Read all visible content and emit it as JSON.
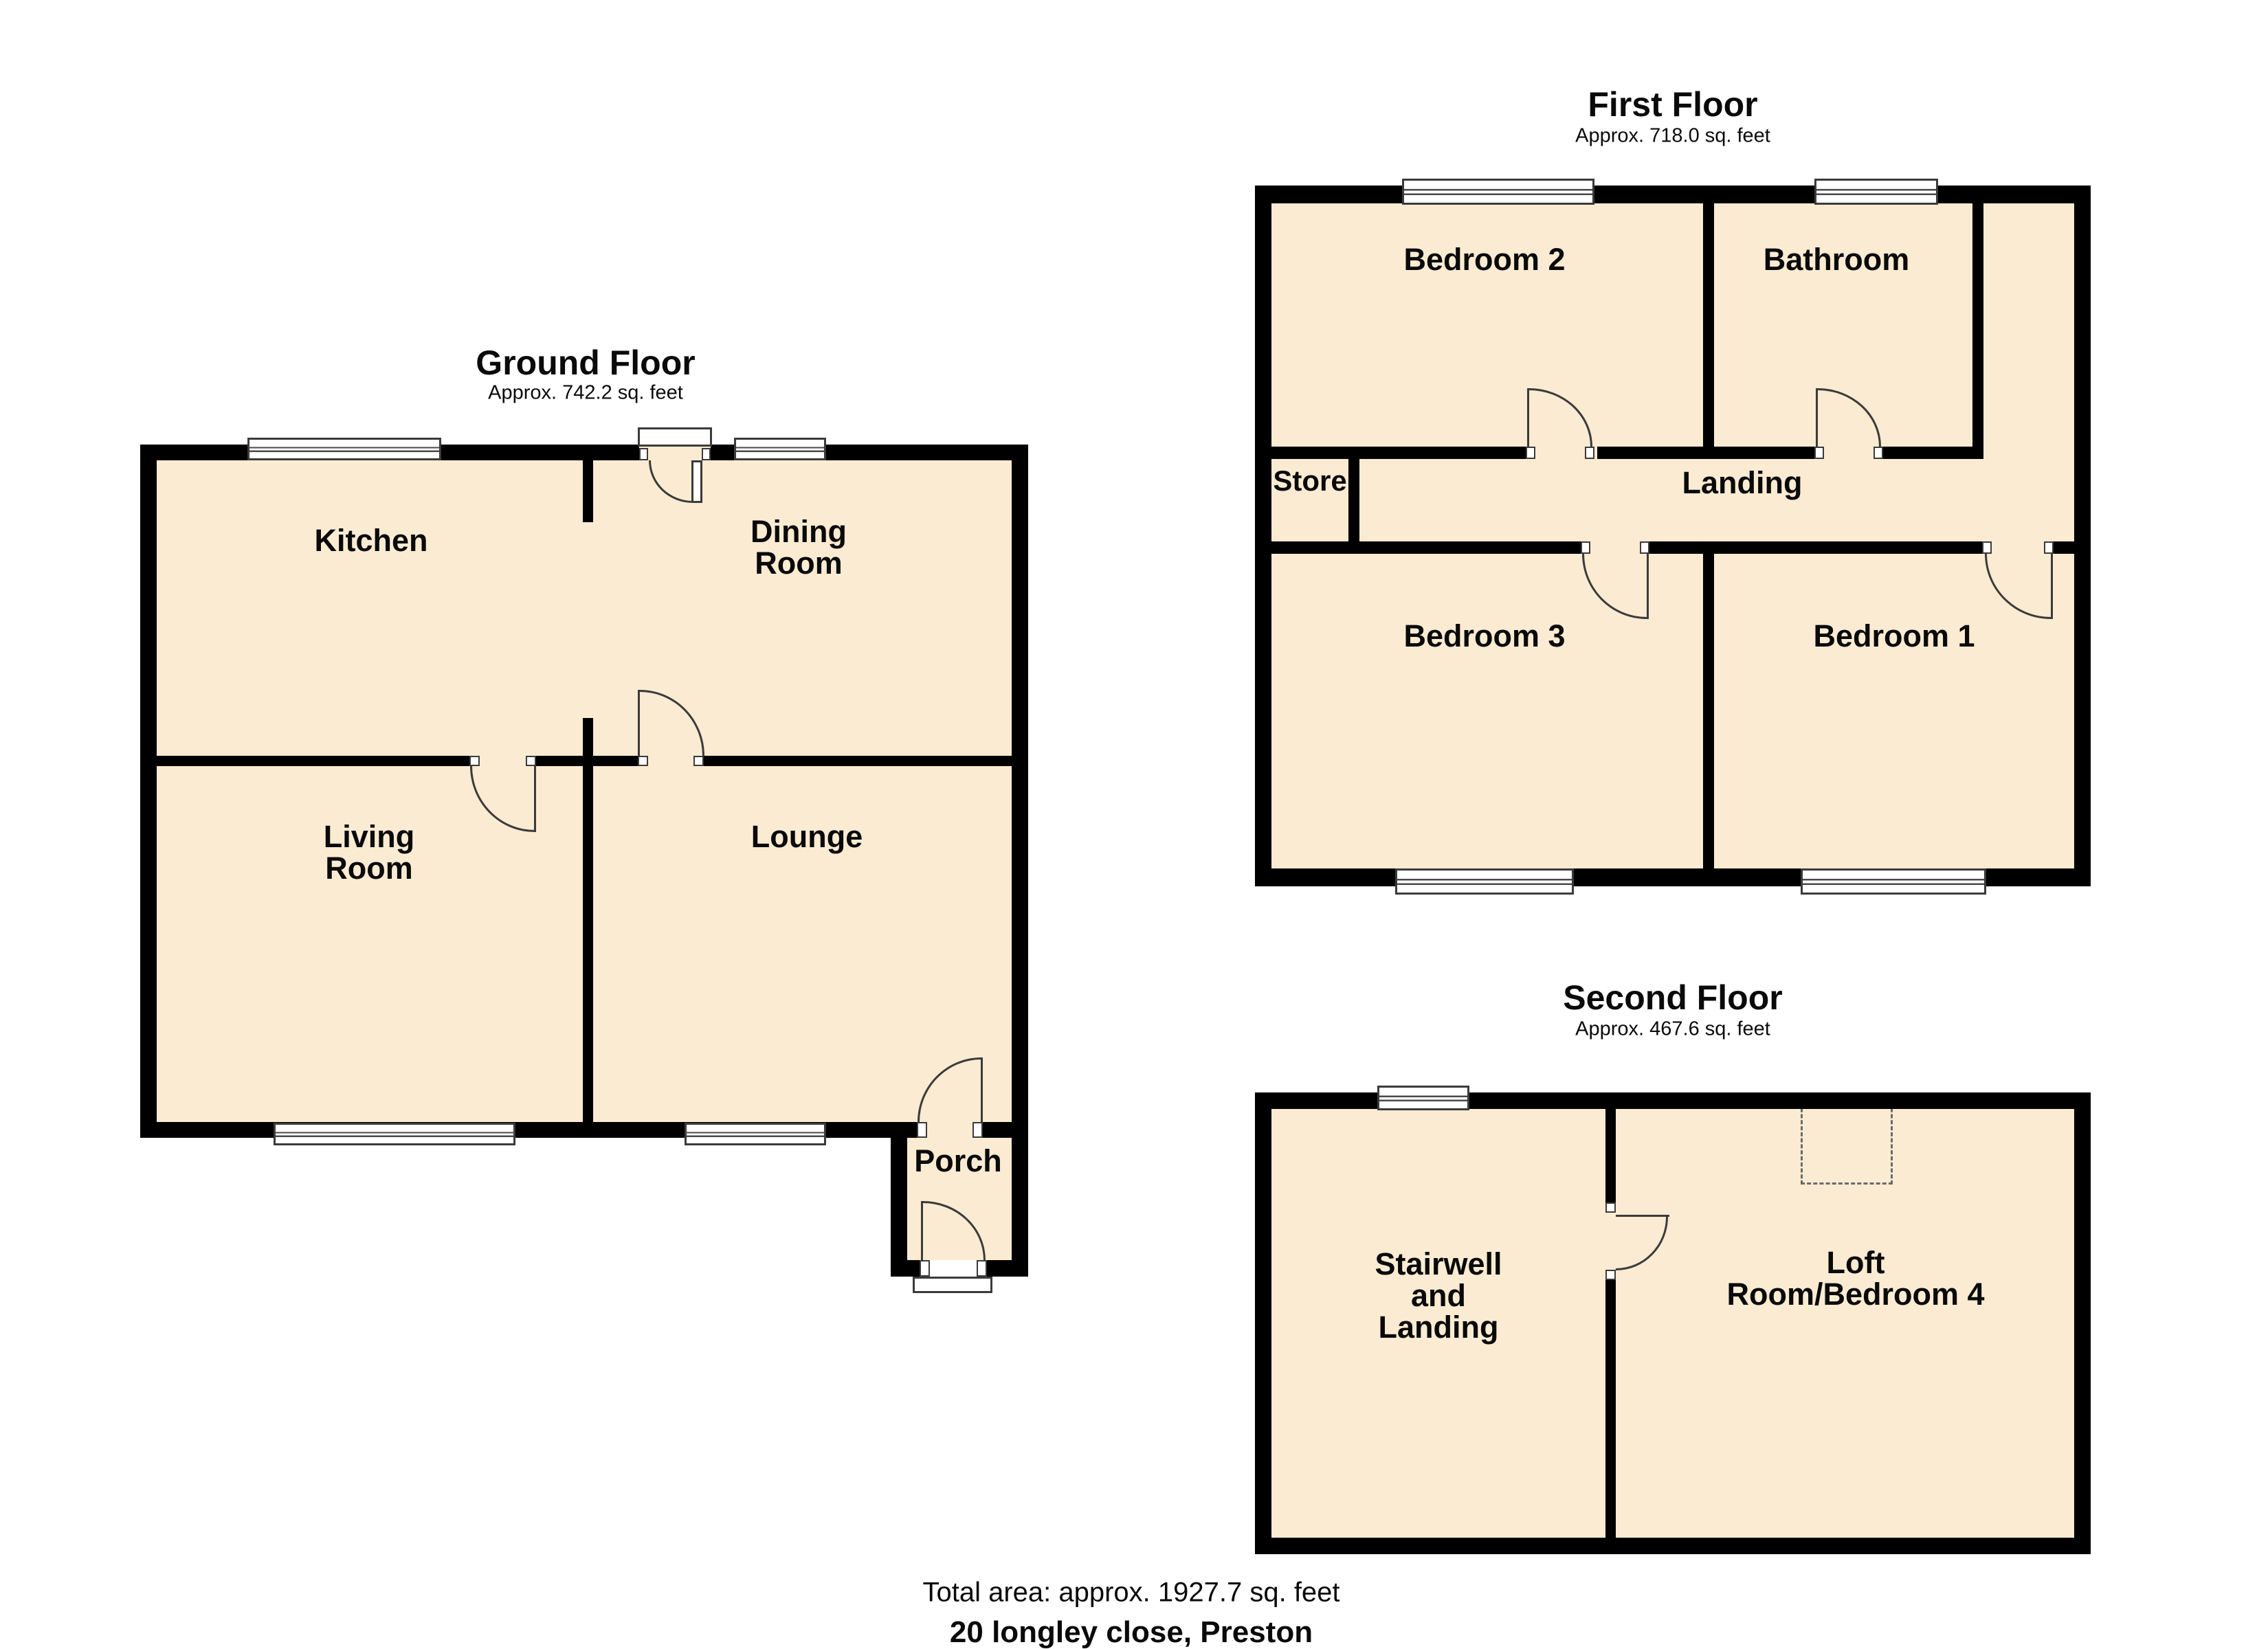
{
  "colors": {
    "room_fill": "#FAEBD2",
    "wall": "#000000",
    "door_window_line": "#3b3b3b",
    "dashed_outline": "#6a6a6a",
    "text": "#0a0a0a"
  },
  "floors": [
    {
      "title": "Ground Floor",
      "area": "Approx. 742.2 sq. feet",
      "rooms": {
        "kitchen": {
          "lines": [
            "Kitchen"
          ]
        },
        "dining": {
          "lines": [
            "Dining",
            "Room"
          ]
        },
        "living": {
          "lines": [
            "Living",
            "Room"
          ]
        },
        "lounge": {
          "lines": [
            "Lounge"
          ]
        },
        "porch": {
          "lines": [
            "Porch"
          ]
        }
      }
    },
    {
      "title": "First Floor",
      "area": "Approx. 718.0 sq. feet",
      "rooms": {
        "bedroom2": {
          "lines": [
            "Bedroom 2"
          ]
        },
        "bathroom": {
          "lines": [
            "Bathroom"
          ]
        },
        "store": {
          "lines": [
            "Store"
          ]
        },
        "landing": {
          "lines": [
            "Landing"
          ]
        },
        "bedroom3": {
          "lines": [
            "Bedroom 3"
          ]
        },
        "bedroom1": {
          "lines": [
            "Bedroom 1"
          ]
        }
      }
    },
    {
      "title": "Second Floor",
      "area": "Approx. 467.6 sq. feet",
      "rooms": {
        "stairwell": {
          "lines": [
            "Stairwell",
            "and",
            "Landing"
          ]
        },
        "loft": {
          "lines": [
            "Loft",
            "Room/Bedroom 4"
          ]
        }
      }
    }
  ],
  "footer": {
    "total_area": "Total area: approx. 1927.7 sq. feet",
    "address": "20 longley close, Preston"
  }
}
